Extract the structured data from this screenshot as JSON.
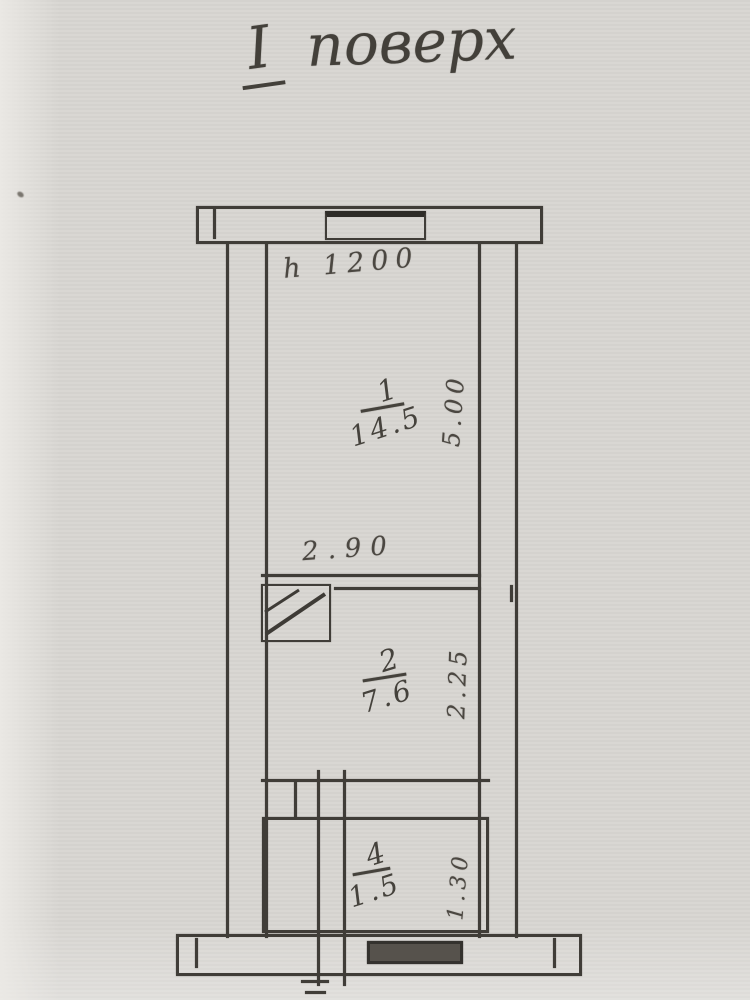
{
  "title": {
    "floor_numeral": "I",
    "floor_word": "поверх"
  },
  "plan": {
    "parapet_height_note": "h 1200",
    "rooms": [
      {
        "number": "1",
        "area": "14.5",
        "width": "2.90",
        "depth": "5.00"
      },
      {
        "number": "2",
        "area": "7.6",
        "depth": "2.25"
      },
      {
        "number": "4",
        "area": "1.5",
        "depth": "1.30"
      }
    ]
  },
  "colors": {
    "paper": "#d8d6d2",
    "ink": "#3e3b36",
    "pencil": "#4b4741"
  }
}
